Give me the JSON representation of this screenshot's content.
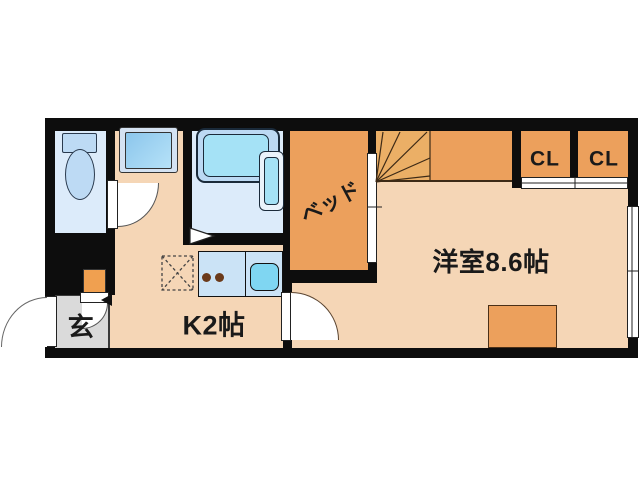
{
  "plan": {
    "type": "apartment-floor-plan",
    "rooms": {
      "entrance": {
        "label": "玄"
      },
      "kitchen": {
        "label": "K2帖"
      },
      "main_room": {
        "label": "洋室8.6帖"
      },
      "bed": {
        "label": "ベッド"
      },
      "closet1": {
        "label": "CL"
      },
      "closet2": {
        "label": "CL"
      }
    },
    "fixtures": [
      "toilet",
      "vanity-sink",
      "bathtub",
      "bath-heater-unit",
      "kitchen-counter",
      "stove-burners",
      "kitchen-sink",
      "refrigerator-space",
      "staircase",
      "shoe-cabinet",
      "entry-door",
      "interior-doors",
      "sliding-doors",
      "window",
      "storage-box"
    ],
    "colors": {
      "wall": "#0d0d0d",
      "peach": "#F5D6B6",
      "orange": "#ECA05C",
      "fan": "#EBAF66",
      "bathfloor": "#DCEBFA",
      "fixture": "#BDDAF4",
      "cyan": "#A5E2F6",
      "counter": "#CBE3F6",
      "sinkblue": "#7FD6F2",
      "gray": "#DADADA",
      "line": "#4a3424"
    }
  }
}
